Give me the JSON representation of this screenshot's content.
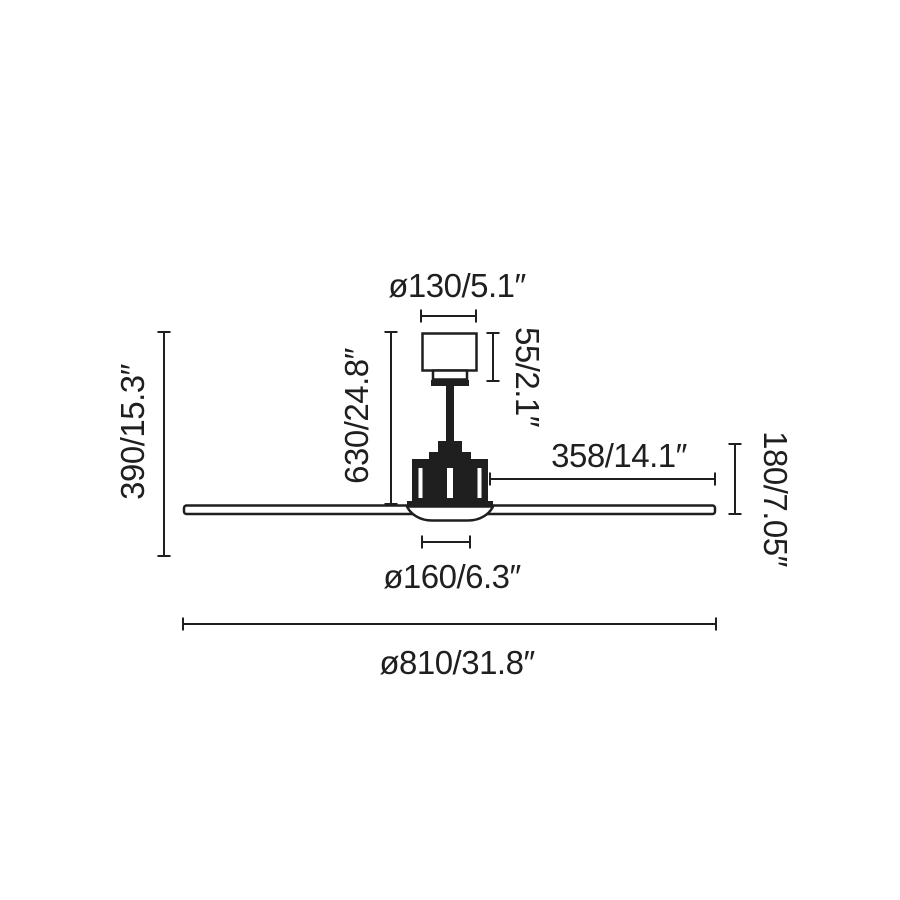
{
  "page": {
    "background_color": "#ffffff",
    "line_color": "#1f1f1f"
  },
  "diagram": {
    "type": "technical-dimension-drawing",
    "subject": "ceiling-fan-side-view",
    "labels": {
      "canopy_diameter": "ø130/5.1″",
      "canopy_height": "55/2.1″",
      "rod_drop_height": "630/24.8″",
      "total_height": "390/15.3″",
      "blade_length": "358/14.1″",
      "body_height": "180/7.05″",
      "light_diameter": "ø160/6.3″",
      "fan_diameter": "ø810/31.8″"
    }
  }
}
